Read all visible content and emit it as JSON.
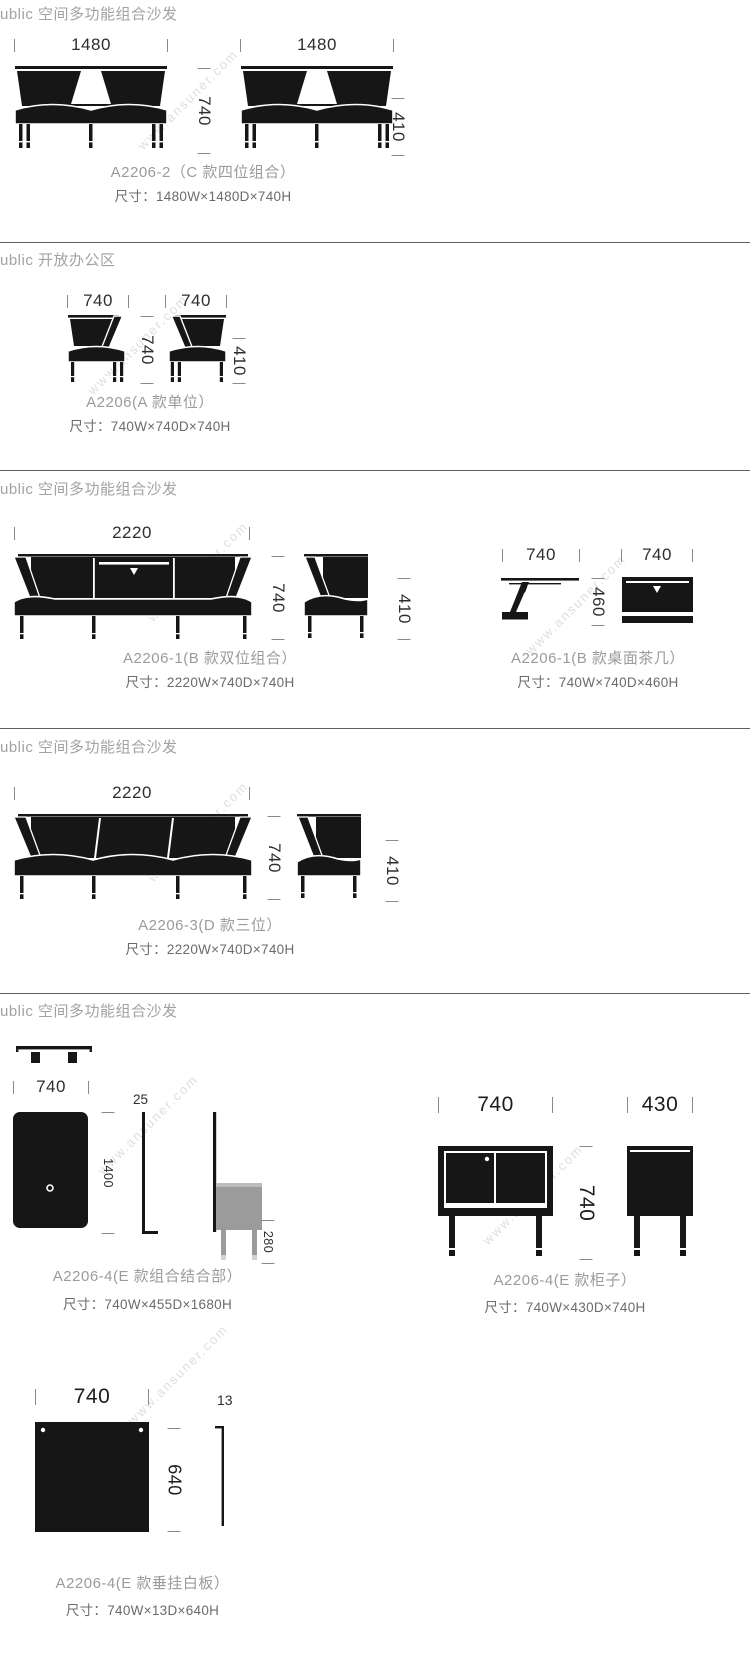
{
  "watermark": "www.ansuner.com",
  "s1": {
    "header": "ublic 空间多功能组合沙发",
    "dim_w1": "1480",
    "dim_w2": "1480",
    "dim_h": "740",
    "dim_seat": "410",
    "caption": "A2206-2（C 款四位组合）",
    "size": "尺寸：1480W×1480D×740H"
  },
  "s2": {
    "header": "ublic 开放办公区",
    "dim_w1": "740",
    "dim_w2": "740",
    "dim_h": "740",
    "dim_seat": "410",
    "caption": "A2206(A 款单位）",
    "size": "尺寸：740W×740D×740H"
  },
  "s3": {
    "header": "ublic 空间多功能组合沙发",
    "sofa": {
      "dim_w": "2220",
      "dim_d": "740",
      "dim_h": "740",
      "dim_seat": "410",
      "caption": "A2206-1(B 款双位组合）",
      "size": "尺寸：2220W×740D×740H"
    },
    "table": {
      "dim_d": "740",
      "dim_w": "740",
      "dim_h": "460",
      "caption": "A2206-1(B 款桌面茶几）",
      "size": "尺寸：740W×740D×460H"
    }
  },
  "s4": {
    "header": "ublic 空间多功能组合沙发",
    "dim_w": "2220",
    "dim_d": "740",
    "dim_h": "740",
    "dim_seat": "410",
    "caption": "A2206-3(D 款三位）",
    "size": "尺寸：2220W×740D×740H"
  },
  "s5": {
    "header": "ublic 空间多功能组合沙发",
    "combo": {
      "dim_w": "740",
      "dim_thick": "25",
      "dim_h": "1400",
      "dim_leg": "280",
      "caption": "A2206-4(E 款组合结合部）",
      "size": "尺寸：740W×455D×1680H"
    },
    "cabinet": {
      "dim_w": "740",
      "dim_d": "430",
      "dim_h": "740",
      "caption": "A2206-4(E 款柜子）",
      "size": "尺寸：740W×430D×740H"
    }
  },
  "s6": {
    "dim_w": "740",
    "dim_thick": "13",
    "dim_h": "640",
    "caption": "A2206-4(E 款垂挂白板）",
    "size": "尺寸：740W×13D×640H"
  }
}
